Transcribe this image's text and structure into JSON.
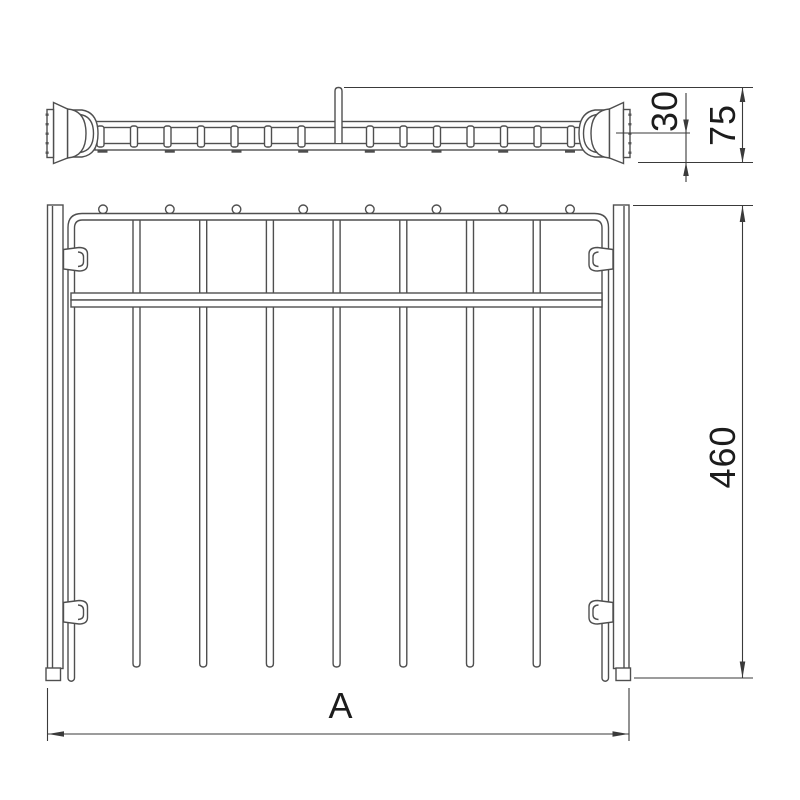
{
  "drawing": {
    "kind": "technical-line-drawing",
    "dimensions": {
      "rail_offset": "30",
      "rail_total_height": "75",
      "frame_depth": "460",
      "frame_width": "A"
    }
  },
  "colors": {
    "line": "#4f4f4f",
    "dim_line": "#3a3a3a",
    "text": "#1c1c1c",
    "background": "#ffffff"
  }
}
